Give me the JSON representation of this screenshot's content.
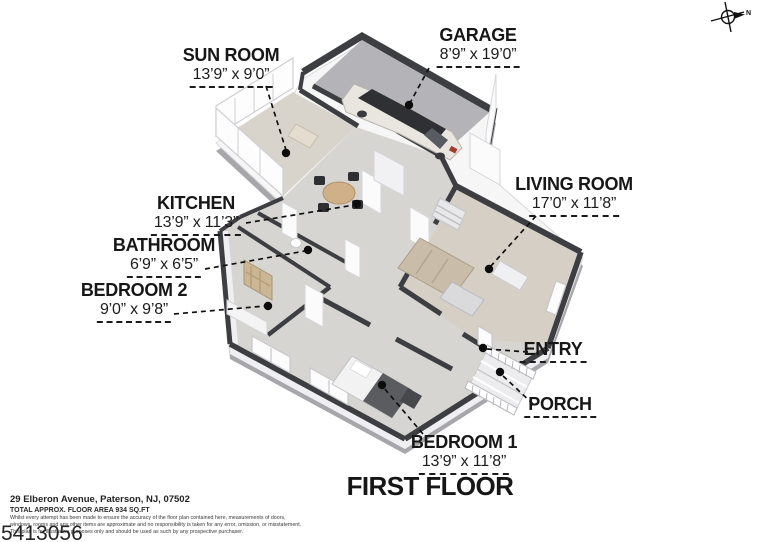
{
  "rooms": {
    "sun_room": {
      "name": "SUN ROOM",
      "dims": "13’9” x 9’0”"
    },
    "garage": {
      "name": "GARAGE",
      "dims": "8’9” x 19’0”"
    },
    "kitchen": {
      "name": "KITCHEN",
      "dims": "13’9” x 11’3”"
    },
    "bathroom": {
      "name": "BATHROOM",
      "dims": "6’9” x 6’5”"
    },
    "bedroom_2": {
      "name": "BEDROOM 2",
      "dims": "9’0” x 9’8”"
    },
    "living_room": {
      "name": "LIVING ROOM",
      "dims": "17’0” x 11’8”"
    },
    "entry": {
      "name": "ENTRY"
    },
    "porch": {
      "name": "PORCH"
    },
    "bedroom_1": {
      "name": "BEDROOM 1",
      "dims": "13’9” x 11’8”"
    }
  },
  "floor_title": "FIRST FLOOR",
  "compass": {
    "label": "N"
  },
  "footer": {
    "address": "29 Elberon Avenue, Paterson, NJ, 07502",
    "area": "TOTAL APPROX. FLOOR AREA 934 SQ.FT",
    "disclaimer_line1": "Whilst every attempt has been made to ensure the accuracy of the floor plan contained here, measurements of doors,",
    "disclaimer_line2": "windows, rooms and any other items are approximate and no responsibility is taken for any error, omission, or misstatement.",
    "disclaimer_line3": "This plan is for illustrative purposes only and should be used as such by any prospective purchaser.",
    "watermark": "5413056"
  },
  "colors": {
    "wall_dark": "#3d3e42",
    "floor_main": "#d7d5d2",
    "floor_sun": "#d8d3cb",
    "floor_living": "#d5cfc6",
    "floor_garage": "#b4b4b8",
    "slab_side": "#a7a7ab",
    "leader": "#111111",
    "label_text": "#1a1a1a"
  }
}
